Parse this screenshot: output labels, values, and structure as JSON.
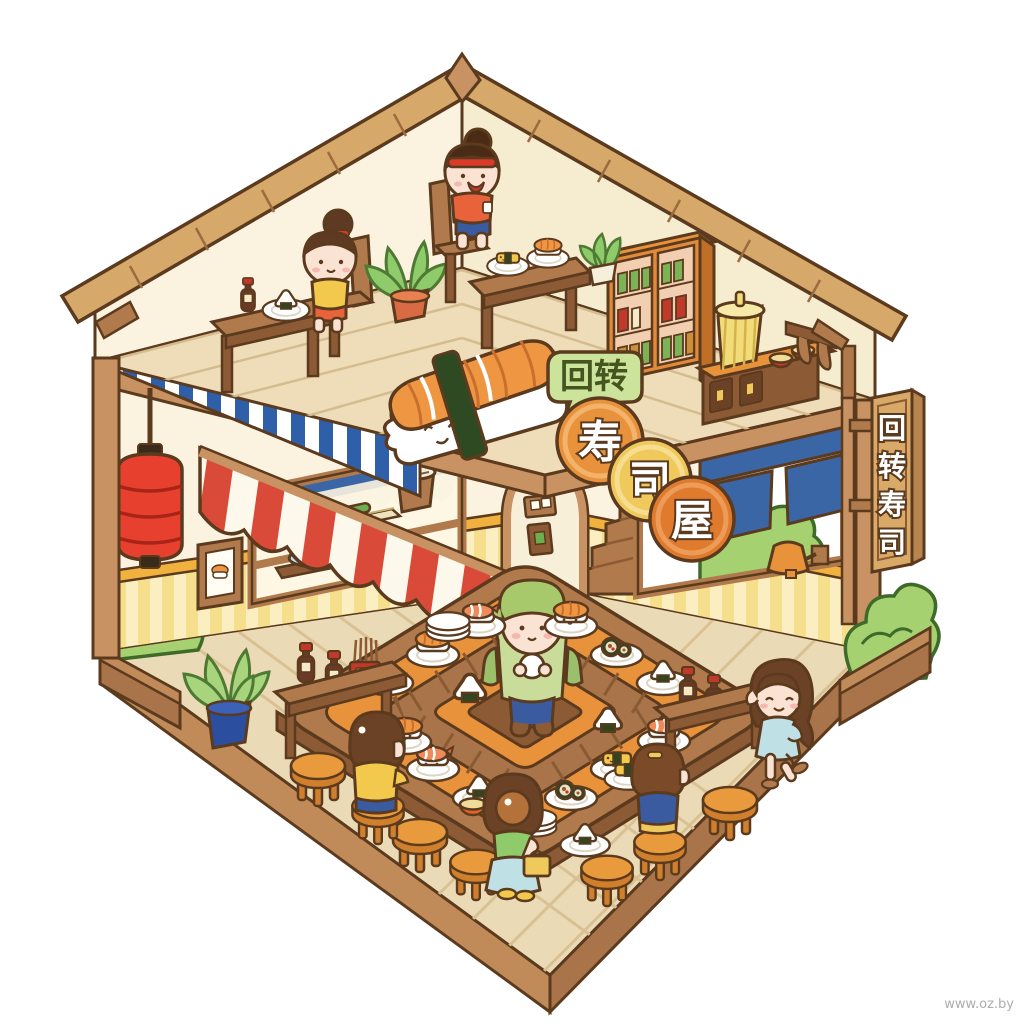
{
  "scene": {
    "type": "isometric cutaway illustration",
    "subject": "kaiten conveyor-belt sushi restaurant with chef and customers",
    "watermark": "www.oz.by"
  },
  "signs": {
    "bubble_label": "回转",
    "shop_circles": [
      "寿",
      "司",
      "屋"
    ],
    "vertical_board": [
      "回",
      "转",
      "寿",
      "司"
    ]
  },
  "palette": {
    "outline": "#5b3a1e",
    "roof_tan": "#d6a869",
    "wood_mid": "#b07a4c",
    "wood_dark": "#8c5b36",
    "cream_wall": "#fbf3df",
    "wainscot_yellow": "#f8e9ae",
    "wainscot_trim": "#f0b13e",
    "awning_red": "#d94a38",
    "railing_blue": "#2f5fa8",
    "belt_orange": "#e8923b",
    "lantern_red": "#e8402e",
    "noren_blue": "#3a66a6",
    "plant_green": "#a6d171",
    "floor_tan": "#ebdab6",
    "stool_orange": "#e89a3c"
  },
  "elements": {
    "chef": "sushi chef at belt center",
    "customers": [
      "girl in yellow at counter",
      "standing girl in green with bag",
      "girl in blue on stool",
      "girl in light blue dress walking",
      "girl upstairs at low table",
      "boy upstairs with headband"
    ],
    "props": [
      "conveyor belt ring",
      "sushi plates",
      "red paper lantern",
      "noren curtain",
      "giant nigiri sign",
      "stools",
      "soy sauce bottles",
      "arch doorway",
      "stairs",
      "wall lamp",
      "rice bucket",
      "fish on cutting board",
      "framed sushi picture",
      "jar cabinet",
      "yellow basket",
      "hanging ladles",
      "potted plants",
      "bushes in planters"
    ]
  }
}
